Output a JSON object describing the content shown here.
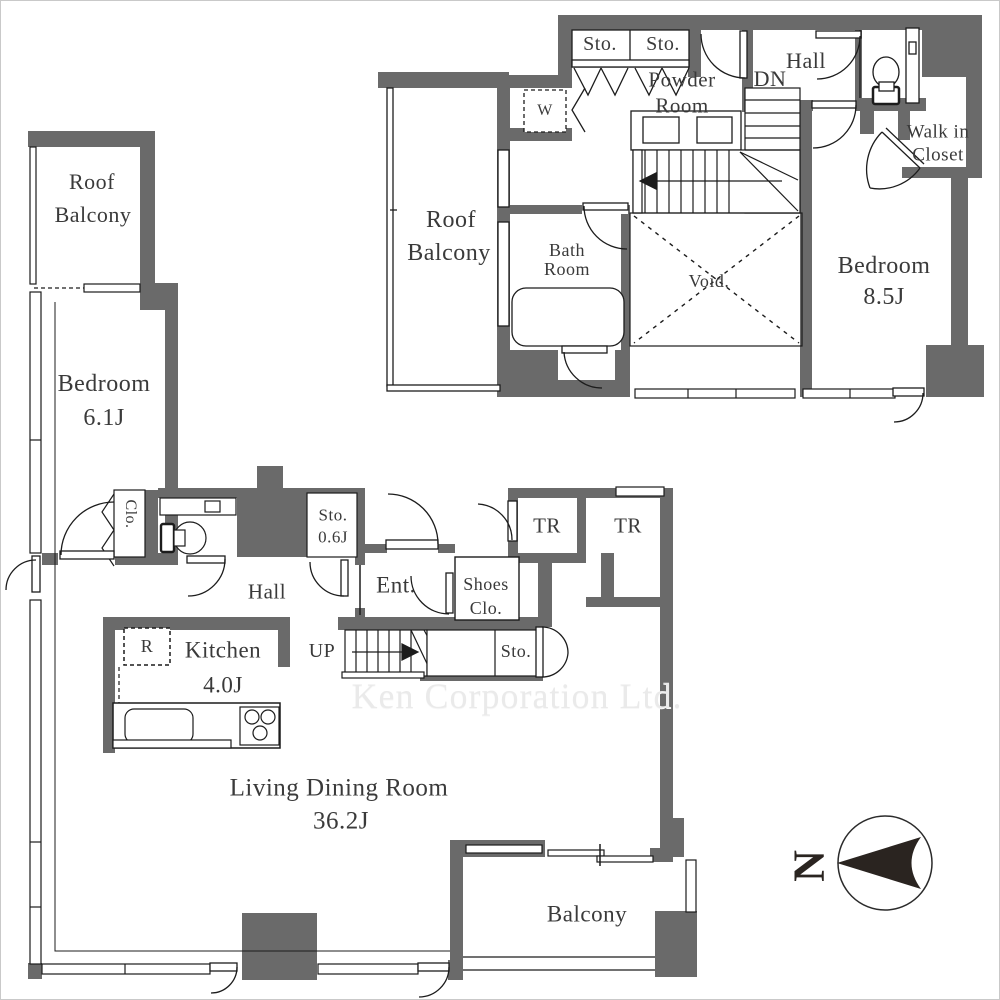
{
  "colors": {
    "wall": "#6a6a6a",
    "line": "#1c1c1c",
    "text": "#3a3a3a",
    "watermark": "#eaeaea",
    "paper": "#ffffff"
  },
  "watermark": "Ken Corporation Ltd.",
  "compass": {
    "north": "N"
  },
  "upper_floor": {
    "roof_balcony": {
      "line1": "Roof",
      "line2": "Balcony"
    },
    "storage_left": "Sto.",
    "storage_right": "Sto.",
    "washer": "W",
    "powder_room": {
      "line1": "Powder",
      "line2": "Room"
    },
    "stairs": "DN",
    "hall": "Hall",
    "walk_in_closet": {
      "line1": "Walk in",
      "line2": "Closet"
    },
    "bath_room": {
      "line1": "Bath",
      "line2": "Room"
    },
    "void": "Void.",
    "bedroom": {
      "name": "Bedroom",
      "size": "8.5J"
    }
  },
  "lower_floor": {
    "roof_balcony": {
      "line1": "Roof",
      "line2": "Balcony"
    },
    "bedroom": {
      "name": "Bedroom",
      "size": "6.1J"
    },
    "closet": "Clo.",
    "storage_06": {
      "line1": "Sto.",
      "line2": "0.6J"
    },
    "hall": "Hall",
    "entrance": "Ent.",
    "shoes_closet": {
      "line1": "Shoes",
      "line2": "Clo."
    },
    "trunk_room_left": "TR",
    "trunk_room_right": "TR",
    "kitchen": {
      "name": "Kitchen",
      "size": "4.0J"
    },
    "refrigerator": "R",
    "stairs": "UP",
    "storage": "Sto.",
    "living_dining_room": {
      "name": "Living Dining Room",
      "size": "36.2J"
    },
    "balcony": "Balcony"
  }
}
